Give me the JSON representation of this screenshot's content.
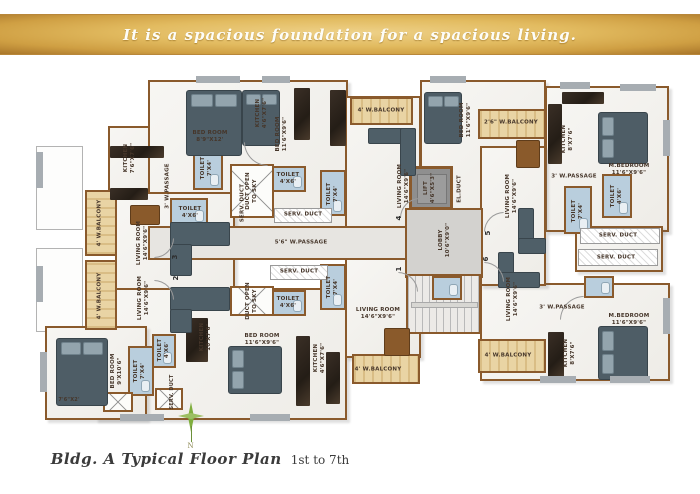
{
  "banner": {
    "tagline": "It is a spacious foundation for a spacious living."
  },
  "caption": {
    "script": "Bldg. A Typical Floor Plan",
    "plain": "1st to 7th",
    "compass_n": "N"
  },
  "colors": {
    "banner_gold": "#e2bb60",
    "wall_brown": "#8a5a2c",
    "balcony_wood": "#e3cc9a",
    "toilet_blue": "#b9cedd",
    "furniture_slate": "#4e5d66",
    "lobby_gray": "#d3d2cf",
    "compass_green": "#7fae3e"
  },
  "plan": {
    "labels": [
      {
        "t": "BED ROOM\n8'9\"X12'"
      },
      {
        "t": "KITCHEN\n7'6\"X7'6\""
      },
      {
        "t": "3' W.PASSAGE"
      },
      {
        "t": "TOILET\n7'X4'"
      },
      {
        "t": "TOILET\n4'X6'"
      },
      {
        "t": "SERV. DUCT"
      },
      {
        "t": "BED ROOM\n11'6\"X9'6\""
      },
      {
        "t": "KITCHEN\n4'6\"X7'6\""
      },
      {
        "t": "DUCT OPEN\nTO SKY"
      },
      {
        "t": "4' W.BALCONY"
      },
      {
        "t": "LIVING ROOM\n14'6\"X9'6\""
      },
      {
        "t": "LIFT\n4'6\"X5'3\""
      },
      {
        "t": "EL.DUCT"
      },
      {
        "t": "BED ROOM\n11'6\"X9'6\""
      },
      {
        "t": "2'6\" W.BALCONY"
      },
      {
        "t": "KITCHEN\n8'X7'6\""
      },
      {
        "t": "M.BEDROOM\n11'6\"X9'6\""
      },
      {
        "t": "3' W.PASSAGE"
      },
      {
        "t": "TOILET\n4'X6'"
      },
      {
        "t": "TOILET\n7'X4'"
      },
      {
        "t": "SERV. DUCT"
      },
      {
        "t": "SERV. DUCT"
      },
      {
        "t": "LIVING ROOM\n14'6\"X9'6\""
      },
      {
        "t": "5'6\" W.PASSAGE"
      },
      {
        "t": "SERV. DUCT"
      },
      {
        "t": "SERV. DUCT"
      },
      {
        "t": "TOILET\n4'X6'"
      },
      {
        "t": "TOILET\n7'X4'"
      },
      {
        "t": "TOILET\n4'X6'"
      },
      {
        "t": "TOILET\n7'X4'"
      },
      {
        "t": "LOBBY\n10'6\"X9'0\""
      },
      {
        "t": "BED ROOM\n11'6\"X9'6\""
      },
      {
        "t": "KITCHEN\n4'6\"X7'6\""
      },
      {
        "t": "LIVING ROOM\n14'6\"X9'6\""
      },
      {
        "t": "4' W.BALCONY"
      },
      {
        "t": "DUCT OPEN\nTO SKY"
      },
      {
        "t": "LIVING ROOM\n14'6\"X9'6\""
      },
      {
        "t": "3' W.PASSAGE"
      },
      {
        "t": "M.BEDROOM\n11'6\"X9'6\""
      },
      {
        "t": "KITCHEN\n8'X7'6\""
      },
      {
        "t": "4' W.BALCONY"
      },
      {
        "t": "BED ROOM\n9'X10'6\""
      },
      {
        "t": "TOILET\n7'X4'"
      },
      {
        "t": "TOILET\n4'X6'"
      },
      {
        "t": "SERV. DUCT"
      },
      {
        "t": "KITCHEN\n10'X7'6\""
      },
      {
        "t": "7'6\"X2'"
      },
      {
        "t": "4' W.BALCONY"
      },
      {
        "t": "4' W.BALCONY"
      },
      {
        "t": "LIVING ROOM\n14'6\"X9'6\""
      },
      {
        "t": "LIVING ROOM\n14'6\"X9'6\""
      }
    ],
    "flat_numbers": [
      {
        "n": "1"
      },
      {
        "n": "2"
      },
      {
        "n": "3"
      },
      {
        "n": "4"
      },
      {
        "n": "5"
      },
      {
        "n": "6"
      }
    ]
  }
}
